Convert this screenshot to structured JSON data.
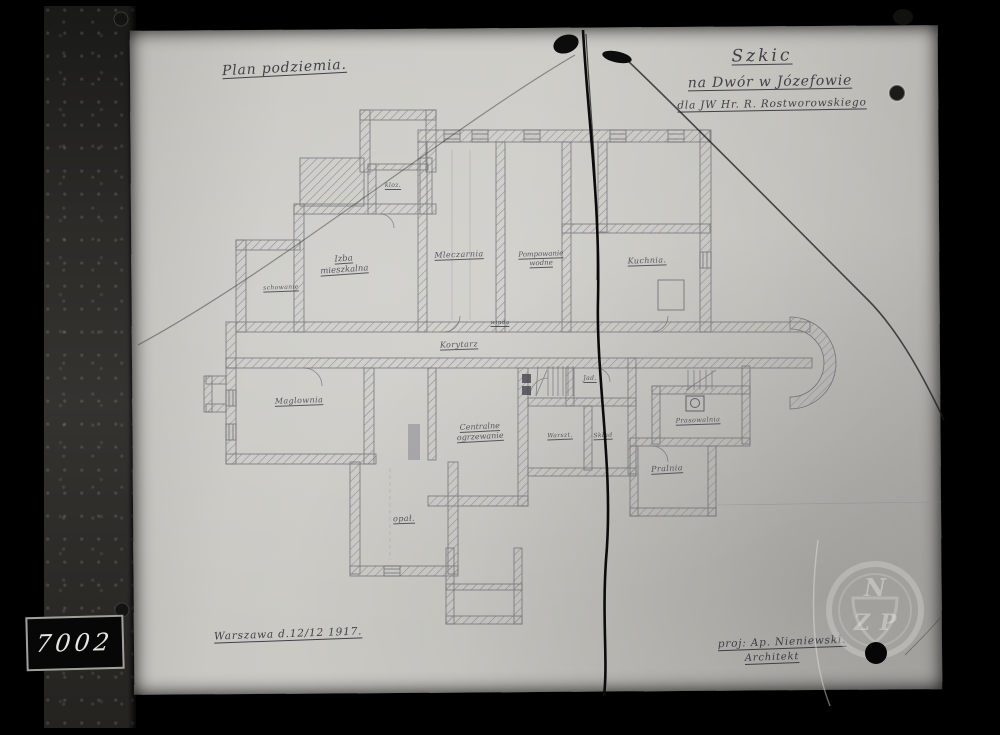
{
  "photo": {
    "plate_number": "7002",
    "stamp": {
      "letter_top": "N",
      "letter_left": "Z",
      "letter_right": "P"
    }
  },
  "titles": {
    "plan_label": "Plan podziemia.",
    "sketch_line1": "Szkic",
    "sketch_line2": "na Dwór w Józefowie",
    "sketch_line3": "dla JW Hr. R. Rostworowskiego",
    "place_date": "Warszawa d.12/12 1917.",
    "architect_line1": "proj: Ap. Nieniewski.",
    "architect_line2": "Architekt"
  },
  "rooms": {
    "kloz": "kloz.",
    "izba_1": "Izba",
    "izba_2": "mieszkalna",
    "schowanie": "schowanie",
    "mleczarnia": "Mleczarnia",
    "pompowanie_1": "Pompowanie",
    "pompowanie_2": "wodne",
    "kuchnia": "Kuchnia.",
    "winda": "winda",
    "korytarz": "Korytarz",
    "maglownia": "Maglownia",
    "centralne_1": "Centralne",
    "centralne_2": "ogrzewanie",
    "warsztat": "Warszt.",
    "jad": "Jad.",
    "sklad": "Skład",
    "prasowalnia": "Prasowalnia",
    "pralnia": "Pralnia",
    "opal": "opał."
  },
  "colors": {
    "frame": "#000000",
    "board": "#2c2b28",
    "paper": "#c9c8c3",
    "pencil": "#5e5e66",
    "ink": "#32323b",
    "crack": "#0b0b0b",
    "stamp": "#e6e6de"
  }
}
